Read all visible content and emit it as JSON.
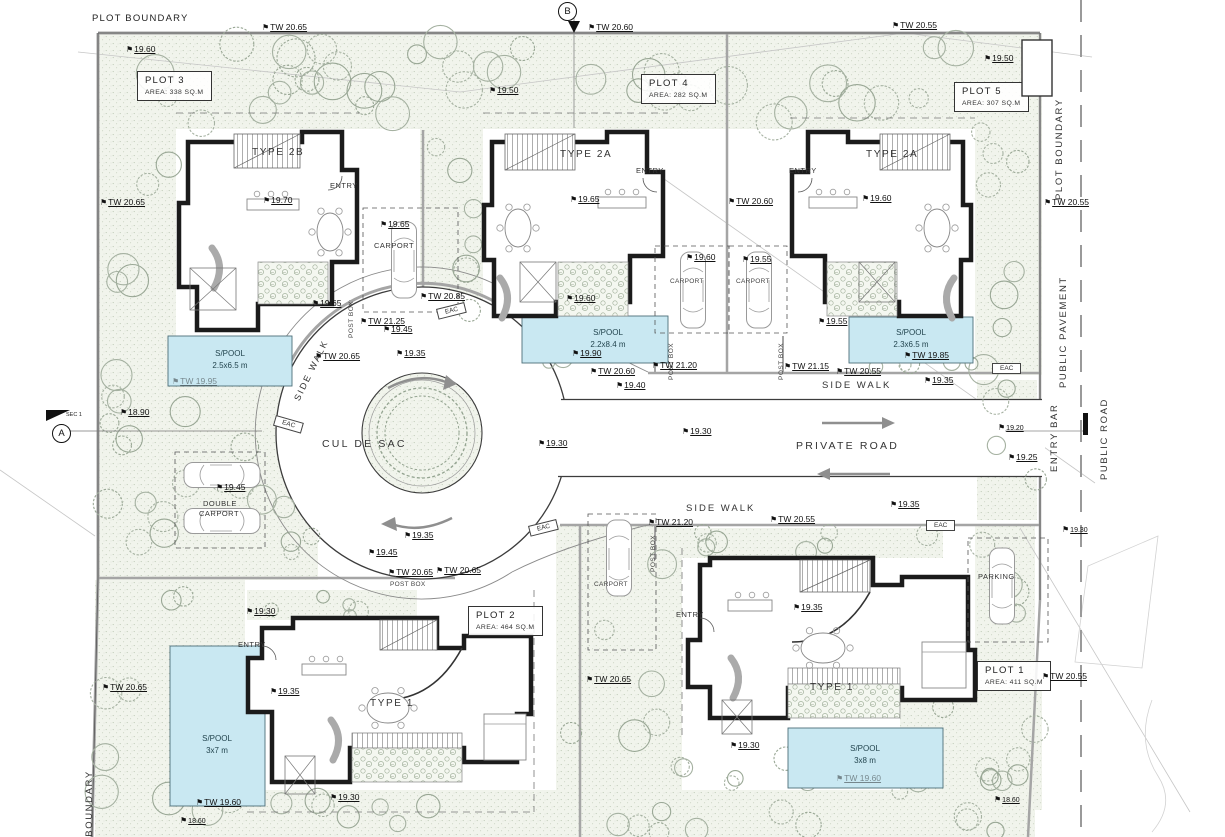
{
  "title": "Residential development site plan - 5 plots",
  "colors": {
    "pool": "#c9e8f2",
    "wall": "#1b1b1b",
    "green": "#f1f4ec",
    "tree": "#a5b1a1",
    "gray_wall": "#a5a5a5",
    "arrow": "#8f8f8f"
  },
  "markers": {
    "b": {
      "label": "B"
    },
    "a": {
      "label": "A",
      "note": "SEC 1"
    }
  },
  "plots": [
    {
      "name": "PLOT 3",
      "area": "AREA: 338 SQ.M",
      "x": 137,
      "y": 71
    },
    {
      "name": "PLOT 4",
      "area": "AREA: 282 SQ.M",
      "x": 641,
      "y": 74
    },
    {
      "name": "PLOT 5",
      "area": "AREA: 307 SQ.M",
      "x": 954,
      "y": 82
    },
    {
      "name": "PLOT 2",
      "area": "AREA: 464 SQ.M",
      "x": 468,
      "y": 606
    },
    {
      "name": "PLOT 1",
      "area": "AREA: 411 SQ.M",
      "x": 977,
      "y": 661
    }
  ],
  "annotations": [
    {
      "t": "PLOT BOUNDARY",
      "x": 92,
      "y": 13,
      "k": "txt",
      "n": "plot-boundary-top-label"
    },
    {
      "t": "TW 20.65",
      "x": 262,
      "y": 22,
      "k": "lvl"
    },
    {
      "t": "TW 20.60",
      "x": 588,
      "y": 22,
      "k": "lvl"
    },
    {
      "t": "TW 20.55",
      "x": 892,
      "y": 20,
      "k": "lvl"
    },
    {
      "t": "19.60",
      "x": 126,
      "y": 44,
      "k": "lvl"
    },
    {
      "t": "19.50",
      "x": 984,
      "y": 53,
      "k": "lvl"
    },
    {
      "t": "BINS",
      "x": 1027,
      "y": 60,
      "k": "stxt",
      "n": "bins-label"
    },
    {
      "t": "19.50",
      "x": 489,
      "y": 85,
      "k": "lvl"
    },
    {
      "t": "TYPE 2B",
      "x": 252,
      "y": 147,
      "k": "type",
      "n": "house-type-label"
    },
    {
      "t": "TYPE 2A",
      "x": 560,
      "y": 149,
      "k": "type",
      "n": "house-type-label"
    },
    {
      "t": "TYPE 2A",
      "x": 866,
      "y": 149,
      "k": "type",
      "n": "house-type-label"
    },
    {
      "t": "ENTRY",
      "x": 330,
      "y": 181,
      "k": "stxt"
    },
    {
      "t": "ENTRY",
      "x": 636,
      "y": 166,
      "k": "stxt"
    },
    {
      "t": "ENTRY",
      "x": 789,
      "y": 166,
      "k": "stxt"
    },
    {
      "t": "TW 20.65",
      "x": 100,
      "y": 197,
      "k": "lvl"
    },
    {
      "t": "19.70",
      "x": 263,
      "y": 195,
      "k": "lvl"
    },
    {
      "t": "19.65",
      "x": 570,
      "y": 194,
      "k": "lvl"
    },
    {
      "t": "19.60",
      "x": 862,
      "y": 193,
      "k": "lvl"
    },
    {
      "t": "TW 20.60",
      "x": 728,
      "y": 196,
      "k": "lvl"
    },
    {
      "t": "TW 20.55",
      "x": 1044,
      "y": 197,
      "k": "lvl"
    },
    {
      "t": "19.65",
      "x": 380,
      "y": 219,
      "k": "lvl"
    },
    {
      "t": "CARPORT",
      "x": 374,
      "y": 241,
      "k": "stxt"
    },
    {
      "t": "19.60",
      "x": 686,
      "y": 252,
      "k": "lvl"
    },
    {
      "t": "19.55",
      "x": 742,
      "y": 254,
      "k": "lvl"
    },
    {
      "t": "CARPORT",
      "x": 670,
      "y": 278,
      "k": "xstxt"
    },
    {
      "t": "CARPORT",
      "x": 736,
      "y": 278,
      "k": "xstxt"
    },
    {
      "t": "TW 20.85",
      "x": 420,
      "y": 291,
      "k": "lvl"
    },
    {
      "t": "19.65",
      "x": 312,
      "y": 298,
      "k": "lvl"
    },
    {
      "t": "19.60",
      "x": 566,
      "y": 293,
      "k": "lvl"
    },
    {
      "t": "19.55",
      "x": 818,
      "y": 316,
      "k": "lvl"
    },
    {
      "t": "POST BOX",
      "x": 348,
      "y": 338,
      "k": "vstxt"
    },
    {
      "t": "POST BOX",
      "x": 668,
      "y": 380,
      "k": "vstxt"
    },
    {
      "t": "POST BOX",
      "x": 778,
      "y": 380,
      "k": "vstxt"
    },
    {
      "t": "TW 21.25",
      "x": 360,
      "y": 316,
      "k": "lvl"
    },
    {
      "t": "19.45",
      "x": 383,
      "y": 324,
      "k": "lvl"
    },
    {
      "t": "19.35",
      "x": 396,
      "y": 348,
      "k": "lvl"
    },
    {
      "t": "TW 20.65",
      "x": 315,
      "y": 351,
      "k": "lvl"
    },
    {
      "t": "19.90",
      "x": 572,
      "y": 348,
      "k": "lvl"
    },
    {
      "t": "TW 20.60",
      "x": 590,
      "y": 366,
      "k": "lvl"
    },
    {
      "t": "TW 21.20",
      "x": 652,
      "y": 360,
      "k": "lvl"
    },
    {
      "t": "TW 21.15",
      "x": 784,
      "y": 361,
      "k": "lvl"
    },
    {
      "t": "TW 20.55",
      "x": 836,
      "y": 366,
      "k": "lvl"
    },
    {
      "t": "19.40",
      "x": 616,
      "y": 380,
      "k": "lvl"
    },
    {
      "t": "TW 19.85",
      "x": 904,
      "y": 350,
      "k": "lvl"
    },
    {
      "t": "19.35",
      "x": 924,
      "y": 375,
      "k": "lvl"
    },
    {
      "t": "TW 19.95",
      "x": 172,
      "y": 376,
      "k": "lvlf"
    },
    {
      "t": "SIDE WALK",
      "x": 292,
      "y": 398,
      "k": "rot",
      "r": -64
    },
    {
      "t": "SIDE WALK",
      "x": 822,
      "y": 380,
      "k": "road2"
    },
    {
      "t": "CUL DE SAC",
      "x": 322,
      "y": 438,
      "k": "road"
    },
    {
      "t": "PRIVATE ROAD",
      "x": 796,
      "y": 440,
      "k": "road"
    },
    {
      "t": "18.90",
      "x": 120,
      "y": 407,
      "k": "lvl"
    },
    {
      "t": "19.30",
      "x": 538,
      "y": 438,
      "k": "lvl"
    },
    {
      "t": "19.30",
      "x": 682,
      "y": 426,
      "k": "lvl"
    },
    {
      "t": "19.20",
      "x": 998,
      "y": 423,
      "k": "lvls"
    },
    {
      "t": "19.25",
      "x": 1008,
      "y": 452,
      "k": "lvl"
    },
    {
      "t": "19.45",
      "x": 216,
      "y": 482,
      "k": "lvl"
    },
    {
      "t": "DOUBLE",
      "x": 203,
      "y": 499,
      "k": "stxt"
    },
    {
      "t": "CARPORT",
      "x": 199,
      "y": 509,
      "k": "stxt"
    },
    {
      "t": "19.35",
      "x": 404,
      "y": 530,
      "k": "lvl"
    },
    {
      "t": "19.45",
      "x": 368,
      "y": 547,
      "k": "lvl"
    },
    {
      "t": "TW 20.65",
      "x": 388,
      "y": 567,
      "k": "lvl"
    },
    {
      "t": "TW 20.65",
      "x": 436,
      "y": 565,
      "k": "lvl"
    },
    {
      "t": "POST BOX",
      "x": 390,
      "y": 581,
      "k": "xstxt"
    },
    {
      "t": "SIDE WALK",
      "x": 686,
      "y": 503,
      "k": "road2"
    },
    {
      "t": "19.35",
      "x": 890,
      "y": 499,
      "k": "lvl"
    },
    {
      "t": "TW 20.55",
      "x": 770,
      "y": 514,
      "k": "lvl"
    },
    {
      "t": "TW 21.20",
      "x": 648,
      "y": 517,
      "k": "lvl"
    },
    {
      "t": "19.30",
      "x": 1062,
      "y": 525,
      "k": "lvls"
    },
    {
      "t": "19.35",
      "x": 793,
      "y": 602,
      "k": "lvl"
    },
    {
      "t": "CARPORT",
      "x": 594,
      "y": 581,
      "k": "xstxt"
    },
    {
      "t": "PARKING",
      "x": 978,
      "y": 572,
      "k": "stxt"
    },
    {
      "t": "POST BOX",
      "x": 650,
      "y": 572,
      "k": "vstxt"
    },
    {
      "t": "TW 20.65",
      "x": 586,
      "y": 674,
      "k": "lvl"
    },
    {
      "t": "19.30",
      "x": 246,
      "y": 606,
      "k": "lvl"
    },
    {
      "t": "ENTRY",
      "x": 238,
      "y": 640,
      "k": "stxt"
    },
    {
      "t": "ENTRY",
      "x": 676,
      "y": 610,
      "k": "stxt"
    },
    {
      "t": "19.35",
      "x": 270,
      "y": 686,
      "k": "lvl"
    },
    {
      "t": "TYPE 1",
      "x": 370,
      "y": 698,
      "k": "type",
      "n": "house-type-label"
    },
    {
      "t": "TYPE 1",
      "x": 810,
      "y": 682,
      "k": "type",
      "n": "house-type-label"
    },
    {
      "t": "TW 20.65",
      "x": 102,
      "y": 682,
      "k": "lvl"
    },
    {
      "t": "TW 20.55",
      "x": 1042,
      "y": 671,
      "k": "lvl"
    },
    {
      "t": "19.30",
      "x": 330,
      "y": 792,
      "k": "lvl"
    },
    {
      "t": "19.30",
      "x": 730,
      "y": 740,
      "k": "lvl"
    },
    {
      "t": "TW 19.60",
      "x": 196,
      "y": 797,
      "k": "lvl"
    },
    {
      "t": "18.60",
      "x": 180,
      "y": 816,
      "k": "lvls"
    },
    {
      "t": "TW 19.60",
      "x": 836,
      "y": 773,
      "k": "lvlf"
    },
    {
      "t": "18.60",
      "x": 994,
      "y": 795,
      "k": "lvls"
    },
    {
      "t": "PLOT BOUNDARY",
      "x": 1054,
      "y": 200,
      "k": "vtxt",
      "n": "plot-boundary-right-label"
    },
    {
      "t": "PUBLIC PAVEMENT",
      "x": 1058,
      "y": 388,
      "k": "vtxt",
      "n": "public-pavement-label"
    },
    {
      "t": "ENTRY BAR",
      "x": 1049,
      "y": 472,
      "k": "vtxt",
      "n": "entry-bar-label"
    },
    {
      "t": "PUBLIC ROAD",
      "x": 1099,
      "y": 480,
      "k": "vtxt",
      "n": "public-road-label"
    },
    {
      "t": "PLOT BOUNDARY",
      "x": 84,
      "y": 872,
      "k": "vtxt",
      "n": "plot-boundary-bottom-label"
    },
    {
      "k": "pool",
      "t": "S/POOL",
      "s": "2.5x6.5 m",
      "x": 230,
      "y": 349
    },
    {
      "k": "pool",
      "t": "S/POOL",
      "s": "2.2x8.4 m",
      "x": 608,
      "y": 328
    },
    {
      "k": "pool",
      "t": "S/POOL",
      "s": "2.3x6.5 m",
      "x": 911,
      "y": 328
    },
    {
      "k": "pool",
      "t": "S/POOL",
      "s": "3x7 m",
      "x": 217,
      "y": 734
    },
    {
      "k": "pool",
      "t": "S/POOL",
      "s": "3x8 m",
      "x": 865,
      "y": 744
    },
    {
      "k": "eac",
      "t": "EAC",
      "x": 436,
      "y": 309,
      "r": -14
    },
    {
      "k": "eac",
      "t": "EAC",
      "x": 276,
      "y": 415,
      "r": 16
    },
    {
      "k": "eac",
      "t": "EAC",
      "x": 992,
      "y": 363,
      "r": 0
    },
    {
      "k": "eac",
      "t": "EAC",
      "x": 528,
      "y": 526,
      "r": -14
    },
    {
      "k": "eac",
      "t": "EAC",
      "x": 926,
      "y": 520,
      "r": 0
    }
  ]
}
